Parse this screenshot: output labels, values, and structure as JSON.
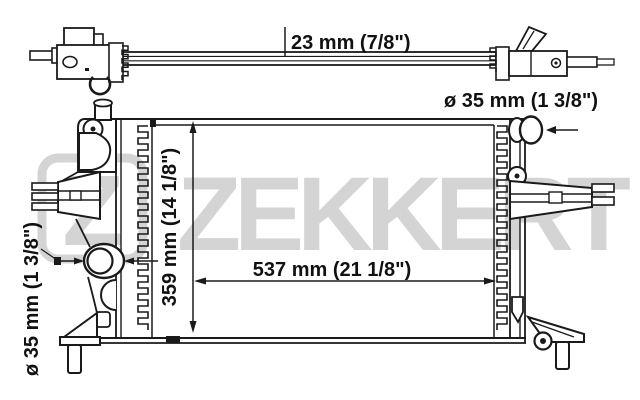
{
  "diagram": {
    "type": "radiator-technical-drawing",
    "brand_watermark": "ZEKKERT",
    "logo_letter": "Z",
    "dimensions": {
      "core_depth": "23 mm (7/8\")",
      "inlet_diameter": "ø 35 mm (1 3/8\")",
      "outlet_diameter": "ø 35 mm (1 3/8\")",
      "core_height": "359 mm (14 1/8\")",
      "core_width": "537 mm (21 1/8\")"
    },
    "colors": {
      "line": "#1a1a1a",
      "watermark": "#d4d4d4",
      "background": "#ffffff"
    }
  }
}
